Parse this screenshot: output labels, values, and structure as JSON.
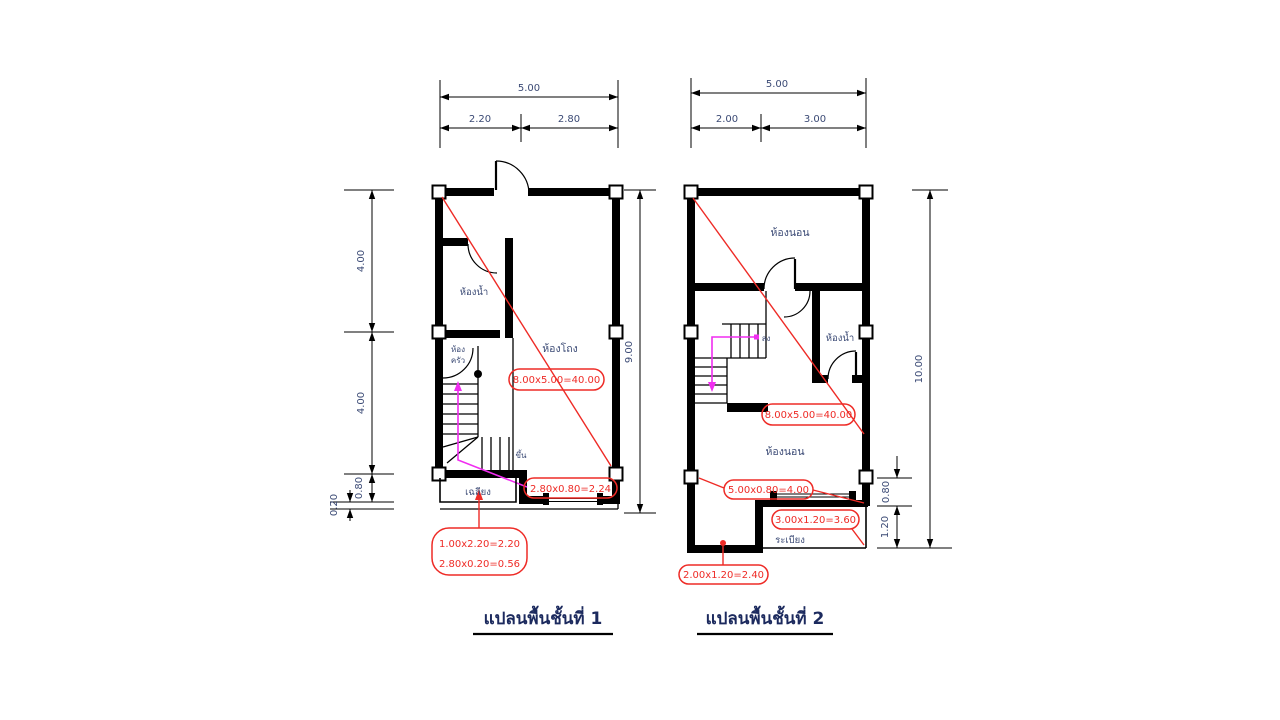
{
  "colors": {
    "wall": "#000000",
    "ink": "#3b4a75",
    "title_ink": "#1c2a5e",
    "annotation_red": "#ee2b26",
    "stair_path_magenta": "#f02df0",
    "background": "#ffffff"
  },
  "plan1": {
    "title": "แปลนพื้นชั้นที่ 1",
    "rooms": {
      "bathroom": "ห้องน้ำ",
      "hall": "ห้องโถง",
      "small_room_line1": "ห้อง",
      "small_room_line2": "ครัว",
      "porch": "เฉลียง",
      "stair_direction": "ขึ้น"
    },
    "labels": {
      "area": "8.00x5.00=40.00",
      "strip": "2.80x0.80=2.24",
      "porch_line1": "1.00x2.20=2.20",
      "porch_line2": "2.80x0.20=0.56"
    },
    "dims": {
      "top_total": "5.00",
      "top_left": "2.20",
      "top_right": "2.80",
      "side_upper": "4.00",
      "side_lower": "4.00",
      "side_small": "0.80",
      "side_tiny": "0.20",
      "height_total": "9.00"
    }
  },
  "plan2": {
    "title": "แปลนพื้นชั้นที่ 2",
    "rooms": {
      "bedroom_upper": "ห้องนอน",
      "bathroom": "ห้องน้ำ",
      "bedroom_lower": "ห้องนอน",
      "balcony": "ระเบียง",
      "stair_direction": "ลง"
    },
    "labels": {
      "area": "8.00x5.00=40.00",
      "strip": "5.00x0.80=4.00",
      "balcony": "3.00x1.20=3.60",
      "nook": "2.00x1.20=2.40"
    },
    "dims": {
      "top_total": "5.00",
      "top_left": "2.00",
      "top_right": "3.00",
      "height_total": "10.00",
      "side_small": "0.80",
      "side_tiny": "1.20"
    }
  }
}
